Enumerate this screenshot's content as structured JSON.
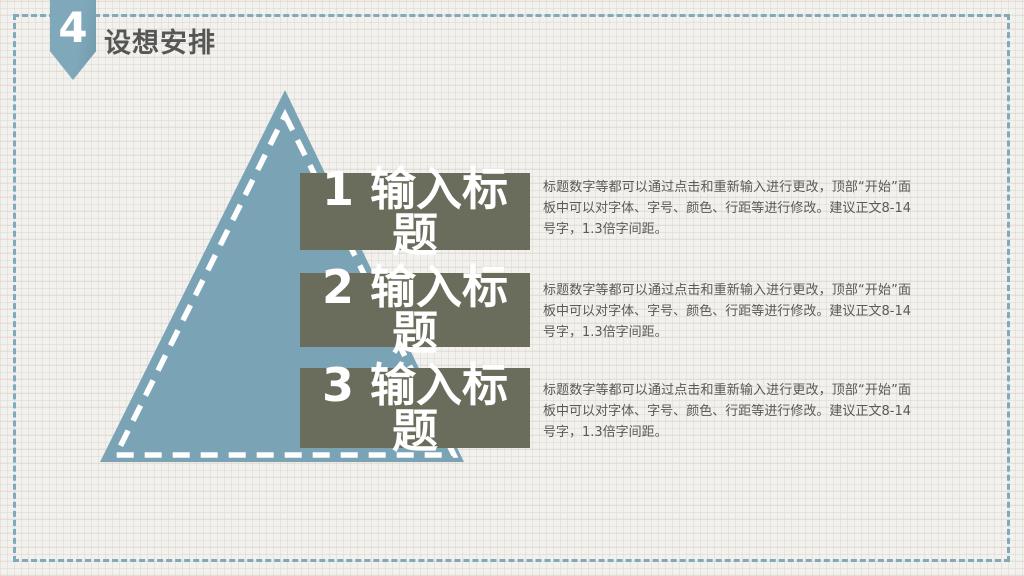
{
  "slide": {
    "badge_number": "4",
    "title": "设想安排"
  },
  "items": [
    {
      "number": "1",
      "title": "1 输入标题",
      "title_lines": [
        "1 输入标",
        "题"
      ],
      "body": "标题数字等都可以通过点击和重新输入进行更改，顶部“开始”面板中可以对字体、字号、颜色、行距等进行修改。建议正文8-14号字，1.3倍字间距。"
    },
    {
      "number": "2",
      "title": "2 输入标题",
      "title_lines": [
        "2 输入标",
        "题"
      ],
      "body": "标题数字等都可以通过点击和重新输入进行更改，顶部“开始”面板中可以对字体、字号、颜色、行距等进行修改。建议正文8-14号字，1.3倍字间距。"
    },
    {
      "number": "3",
      "title": "3 输入标题",
      "title_lines": [
        "3 输入标",
        "题"
      ],
      "body": "标题数字等都可以通过点击和重新输入进行更改，顶部“开始”面板中可以对字体、字号、颜色、行距等进行修改。建议正文8-14号字，1.3倍字间距。"
    }
  ],
  "colors": {
    "triangle_blue": "#7aa4b5",
    "bar_olive": "#6a6d5c",
    "border_dash_blue": "#7fa9bd",
    "ribbon_blue": "#7fa9ba",
    "text_gray": "#595959",
    "bar_text": "#ffffff"
  }
}
